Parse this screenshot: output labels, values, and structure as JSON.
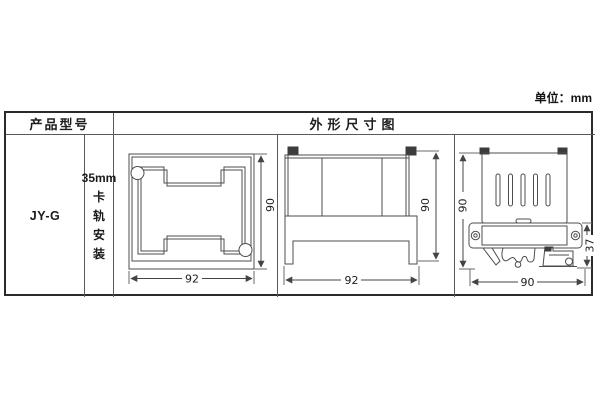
{
  "page": {
    "unit_label": "单位：mm"
  },
  "table": {
    "header": {
      "product_model": "产品型号",
      "dimension_diagram": "外形尺寸图"
    },
    "row": {
      "model": "JY-G",
      "mounting_line1": "35mm",
      "mounting_chars": [
        "卡",
        "轨",
        "安",
        "装"
      ]
    }
  },
  "drawings": {
    "front_view": {
      "width": "92",
      "height": "90"
    },
    "side_view": {
      "width": "92",
      "height": "90"
    },
    "rail_view": {
      "bottom_width": "90",
      "height": "90",
      "base_height": "37"
    }
  },
  "colors": {
    "background": "#ffffff",
    "line": "#4d4d4d",
    "text": "#1c1c1c",
    "outer_border": "#2b2b2b",
    "inner_border": "#595959"
  }
}
